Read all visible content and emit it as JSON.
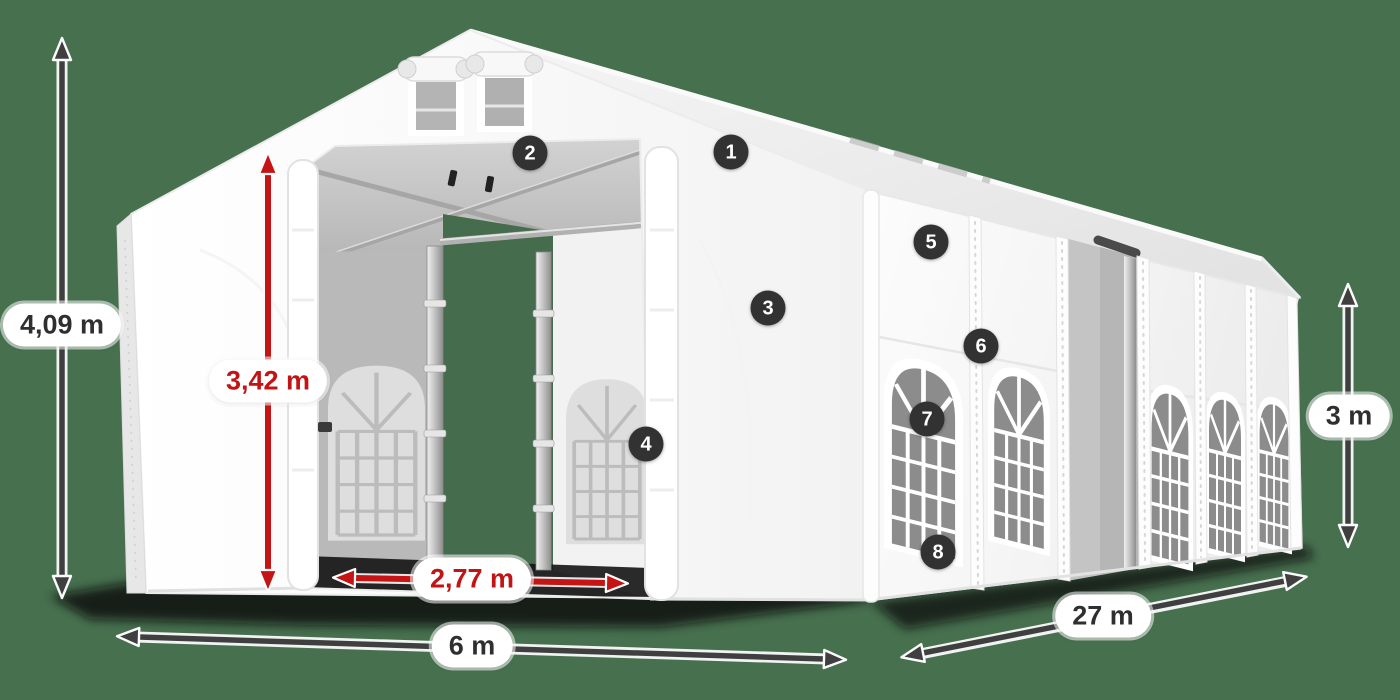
{
  "colors": {
    "background": "#47704F",
    "dimension_dark": "#3F3F3F",
    "dimension_red": "#C41414",
    "marker_badge": "#323232",
    "label_background": "#FFFFFF"
  },
  "dimensions": [
    {
      "id": "total-height",
      "label": "4,09 m",
      "style": "dark"
    },
    {
      "id": "entrance-height",
      "label": "3,42 m",
      "style": "red"
    },
    {
      "id": "entrance-width",
      "label": "2,77 m",
      "style": "red"
    },
    {
      "id": "width",
      "label": "6 m",
      "style": "dark"
    },
    {
      "id": "length",
      "label": "27 m",
      "style": "dark"
    },
    {
      "id": "side-wall-height",
      "label": "3 m",
      "style": "dark"
    }
  ],
  "markers": [
    {
      "number": "1"
    },
    {
      "number": "2"
    },
    {
      "number": "3"
    },
    {
      "number": "4"
    },
    {
      "number": "5"
    },
    {
      "number": "6"
    },
    {
      "number": "7"
    },
    {
      "number": "8"
    }
  ]
}
